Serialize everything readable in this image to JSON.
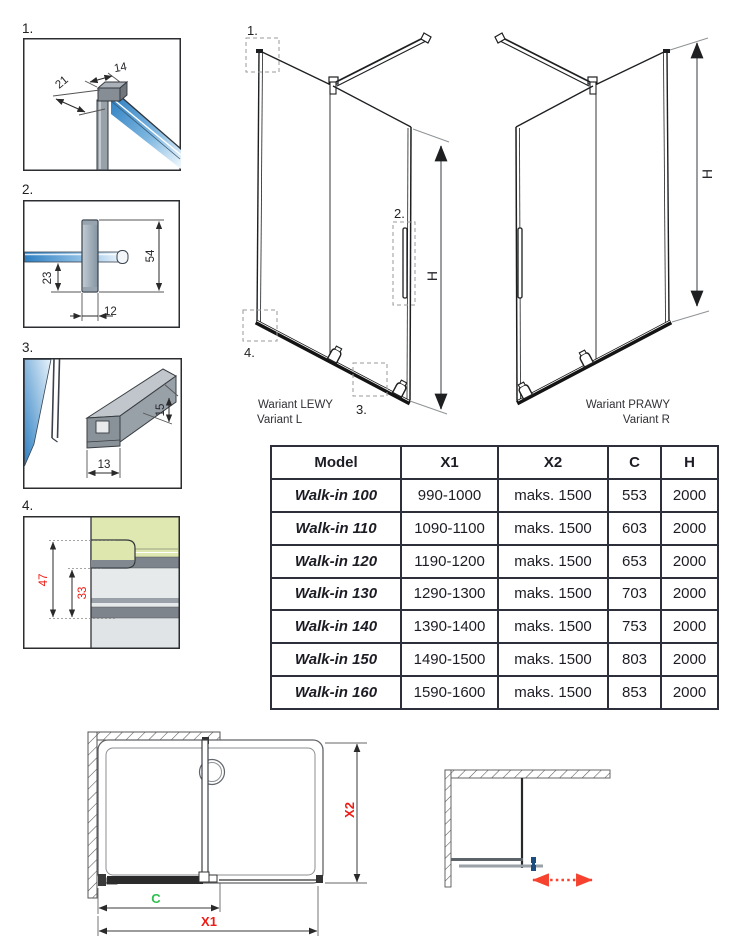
{
  "details": {
    "d1": {
      "label": "1.",
      "dim_width": "14",
      "dim_depth": "21"
    },
    "d2": {
      "label": "2.",
      "dim_total_height": "54",
      "dim_lower_height": "23",
      "dim_width": "12"
    },
    "d3": {
      "label": "3.",
      "dim_height": "15",
      "dim_width": "13"
    },
    "d4": {
      "label": "4.",
      "dim_outer": "47",
      "dim_inner": "33"
    }
  },
  "variant_left": {
    "marker_1": "1.",
    "marker_2": "2.",
    "marker_3": "3.",
    "marker_4": "4.",
    "height_label": "H",
    "caption_pl": "Wariant LEWY",
    "caption_en": "Variant L"
  },
  "variant_right": {
    "height_label": "H",
    "caption_pl": "Wariant PRAWY",
    "caption_en": "Variant R"
  },
  "table": {
    "headers": {
      "model": "Model",
      "x1": "X1",
      "x2": "X2",
      "c": "C",
      "h": "H"
    },
    "rows": [
      {
        "model": "Walk-in 100",
        "x1": "990-1000",
        "x2": "maks. 1500",
        "c": "553",
        "h": "2000"
      },
      {
        "model": "Walk-in 110",
        "x1": "1090-1100",
        "x2": "maks. 1500",
        "c": "603",
        "h": "2000"
      },
      {
        "model": "Walk-in 120",
        "x1": "1190-1200",
        "x2": "maks. 1500",
        "c": "653",
        "h": "2000"
      },
      {
        "model": "Walk-in 130",
        "x1": "1290-1300",
        "x2": "maks. 1500",
        "c": "703",
        "h": "2000"
      },
      {
        "model": "Walk-in 140",
        "x1": "1390-1400",
        "x2": "maks. 1500",
        "c": "753",
        "h": "2000"
      },
      {
        "model": "Walk-in 150",
        "x1": "1490-1500",
        "x2": "maks. 1500",
        "c": "803",
        "h": "2000"
      },
      {
        "model": "Walk-in 160",
        "x1": "1590-1600",
        "x2": "maks. 1500",
        "c": "853",
        "h": "2000"
      }
    ]
  },
  "plan_view": {
    "dim_c": "C",
    "dim_x1": "X1",
    "dim_x2": "X2"
  },
  "colors": {
    "dimension_red": "#ee1c15",
    "dimension_green": "#2fbf4f",
    "glass_blue": "#2e7fc2",
    "table_border": "#2d2f3a",
    "arrow_red": "#f5432f"
  }
}
